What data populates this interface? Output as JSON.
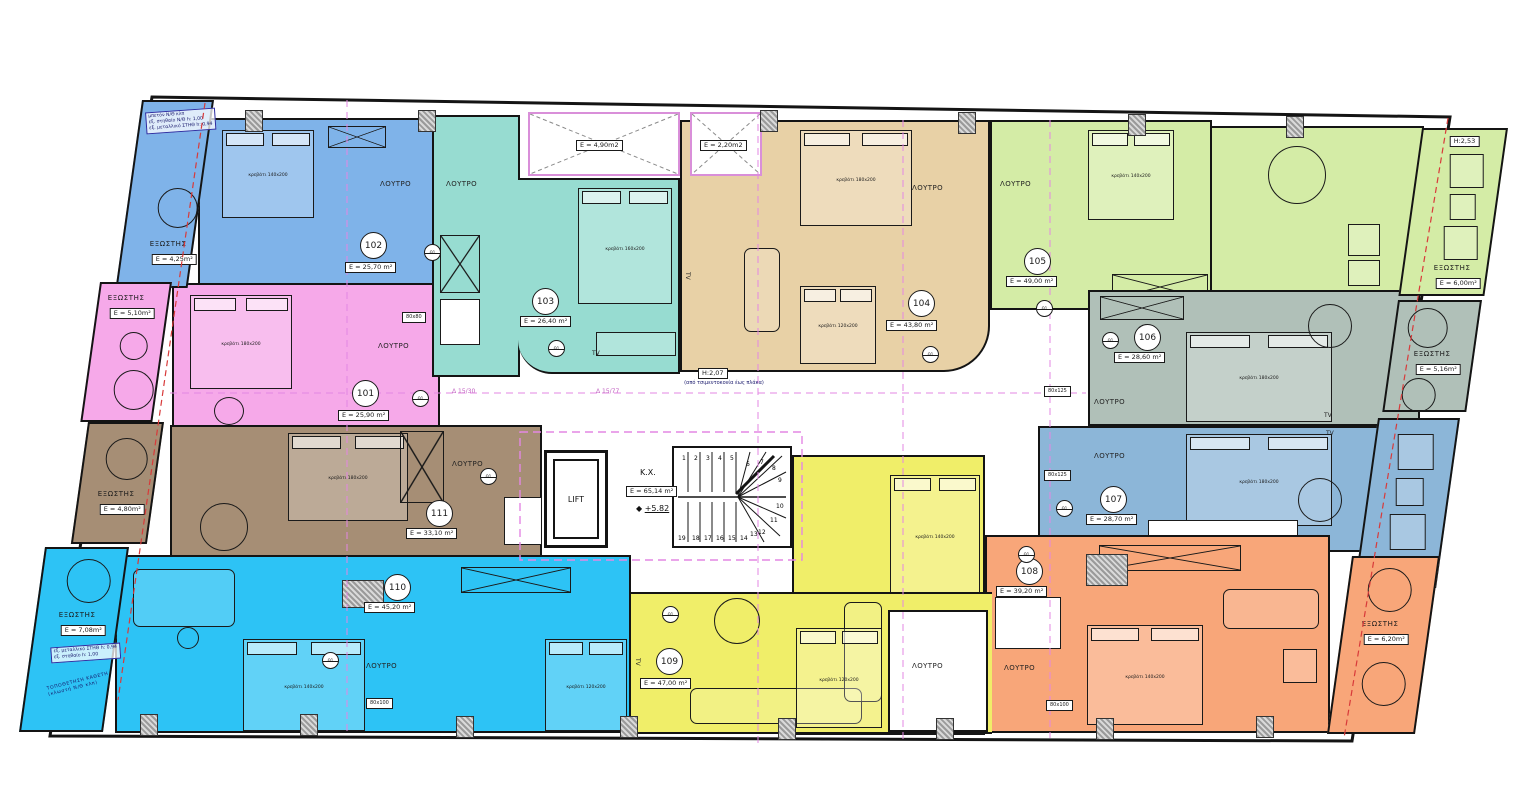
{
  "rooms": [
    {
      "number": "101",
      "area": "E = 25,90 m²",
      "color": "#f6a9e9",
      "bath": "ΛΟΥΤΡΟ",
      "bed": "κρεβάτι 180x200"
    },
    {
      "number": "102",
      "area": "E = 25,70 m²",
      "color": "#7fb3e9",
      "bath": "ΛΟΥΤΡΟ",
      "bed": "κρεβάτι 140x200"
    },
    {
      "number": "103",
      "area": "E = 26,40 m²",
      "color": "#97dcd1",
      "bath": "ΛΟΥΤΡΟ",
      "bed": "κρεβάτι 160x200",
      "tv": "TV"
    },
    {
      "number": "104",
      "area": "E = 43,80 m²",
      "color": "#e8d1a6",
      "bath": "ΛΟΥΤΡΟ",
      "bed": "κρεβάτι 180x200",
      "bed2": "κρεβάτι 120x200",
      "tv": "TV"
    },
    {
      "number": "105",
      "area": "E = 49,00 m²",
      "color": "#d4eca6",
      "bath": "ΛΟΥΤΡΟ",
      "bed": "κρεβάτι 140x200"
    },
    {
      "number": "106",
      "area": "E = 28,60 m²",
      "color": "#b0c0b8",
      "bath": "ΛΟΥΤΡΟ",
      "bed": "κρεβάτι 180x200",
      "tv": "TV"
    },
    {
      "number": "107",
      "area": "E = 28,70 m²",
      "color": "#8cb6d8",
      "bath": "ΛΟΥΤΡΟ",
      "bed": "κρεβάτι 180x200",
      "tv": "TV"
    },
    {
      "number": "108",
      "area": "E = 39,20 m²",
      "color": "#f8a679",
      "bath": "ΛΟΥΤΡΟ",
      "bed": "κρεβάτι 140x200"
    },
    {
      "number": "109",
      "area": "E = 47,00 m²",
      "color": "#f0ee69",
      "bath": "ΛΟΥΤΡΟ",
      "bed": "κρεβάτι 140x200",
      "bed2": "κρεβάτι 120x200",
      "tv": "TV"
    },
    {
      "number": "110",
      "area": "E = 45,20 m²",
      "color": "#2dc3f5",
      "bath": "ΛΟΥΤΡΟ",
      "bed": "κρεβάτι 140x200",
      "bed2": "κρεβάτι 120x200"
    },
    {
      "number": "111",
      "area": "E = 33,10 m²",
      "color": "#a68e75",
      "bath": "ΛΟΥΤΡΟ",
      "bed": "κρεβάτι 180x200"
    }
  ],
  "balconies": [
    {
      "label": "ΕΞΩΣΤΗΣ",
      "area": "E = 4,25m²",
      "color": "#7fb3e9"
    },
    {
      "label": "ΕΞΩΣΤΗΣ",
      "area": "E = 5,10m²",
      "color": "#f6a9e9"
    },
    {
      "label": "ΕΞΩΣΤΗΣ",
      "area": "E = 4,80m²",
      "color": "#a68e75"
    },
    {
      "label": "ΕΞΩΣΤΗΣ",
      "area": "E = 7,08m²",
      "color": "#2dc3f5"
    },
    {
      "label": "ΕΞΩΣΤΗΣ",
      "area": "E = 6,00m²",
      "color": "#d4eca6",
      "height": "H:2,53"
    },
    {
      "label": "ΕΞΩΣΤΗΣ",
      "area": "E = 5,16m²",
      "color": "#b0c0b8"
    },
    {
      "label": "ΕΞΩΣΤΗΣ",
      "area": "E = 5,90m²",
      "color": "#8cb6d8"
    },
    {
      "label": "ΕΞΩΣΤΗΣ",
      "area": "E = 6,20m²",
      "color": "#f8a679"
    }
  ],
  "core": {
    "lift": "LIFT",
    "hall": "K.X.",
    "hall_area": "E = 65,14 m²",
    "level": "+5.82"
  },
  "shafts": [
    {
      "area": "E = 4,90m2"
    },
    {
      "area": "E = 2,20m2"
    }
  ],
  "stairs": {
    "top": [
      "1",
      "2",
      "3",
      "4",
      "5"
    ],
    "fan": [
      "6",
      "7",
      "8",
      "9",
      "10",
      "11",
      "12"
    ],
    "bottom": [
      "19",
      "18",
      "17",
      "16",
      "15",
      "14",
      "13"
    ]
  },
  "notes": {
    "corridor_height": "H:2,07",
    "corridor_height_sub": "(από τσιμεντοκονία έως πλάκα)",
    "dim_left": "Δ 15/30",
    "dim_right": "Δ 15/77",
    "shower_small": "80x80",
    "shower_mid": "80x125",
    "shower_tall": "80x100",
    "door_tag": "Θ1",
    "parapet_note_top_1": "μπετόν Ν/Θ κλπ",
    "parapet_note_top_2": "εξ. στηθαίο Ν/Θ h: 1,00",
    "parapet_note_top_3": "εξ. μεταλλικό ΣΤΗΘ h: 0,94",
    "parapet_note_bottom_1": "εξ. μεταλλικό ΣΤΗΘ h: 0,94",
    "parapet_note_bottom_2": "εξ. στηθαίο h: 1,00",
    "parapet_note_bottom_3": "ΤΟΠΟΘΕΤΗΣΗ ΚΑΘΕΤΗ (κλωστή Ν/Θ κλπ)"
  }
}
